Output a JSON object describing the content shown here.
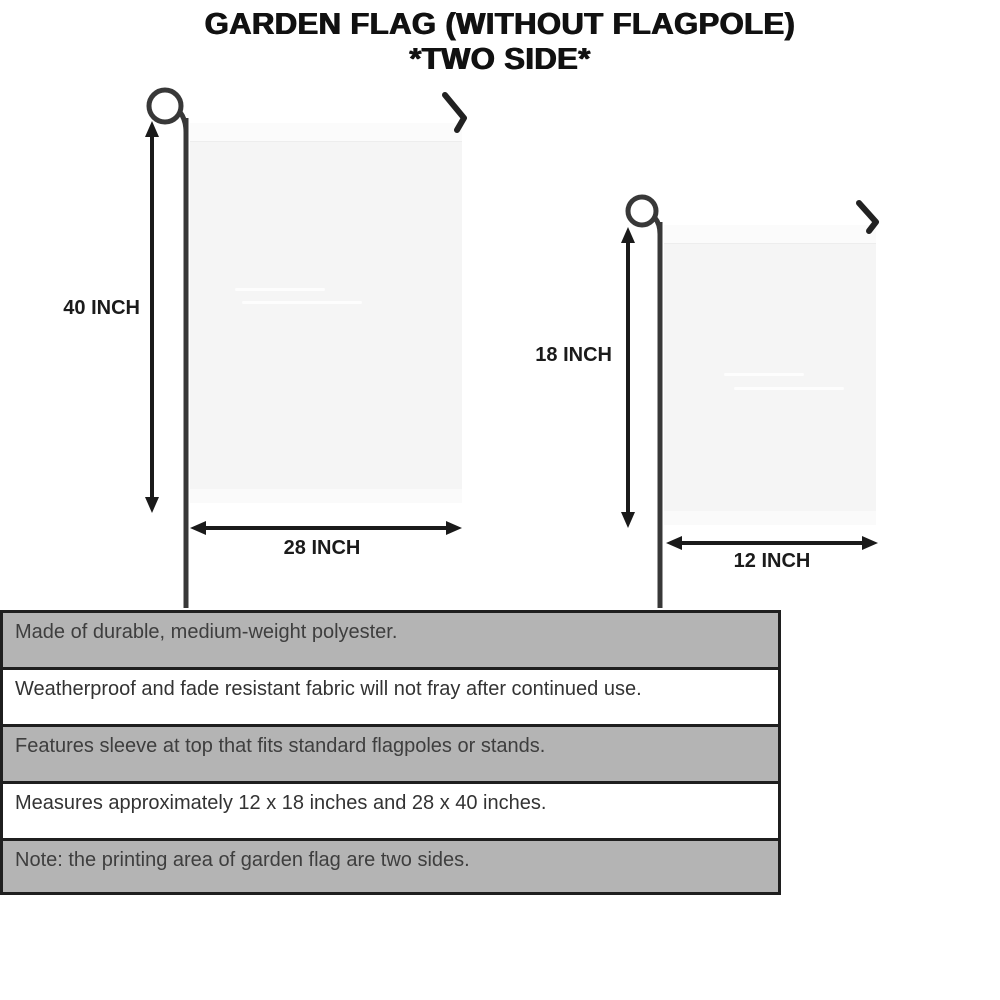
{
  "title": {
    "line1": "GARDEN FLAG (WITHOUT FLAGPOLE)",
    "line2": "*TWO SIDE*"
  },
  "diagram": {
    "large_flag": {
      "height_label": "40 INCH",
      "width_label": "28 INCH"
    },
    "small_flag": {
      "height_label": "18 INCH",
      "width_label": "12 INCH"
    }
  },
  "features": {
    "rows": [
      {
        "text": "Made of durable, medium-weight polyester.",
        "shaded": true
      },
      {
        "text": "Weatherproof and fade resistant fabric will not fray after continued use.",
        "shaded": false
      },
      {
        "text": "Features sleeve at top that fits standard flagpoles or stands.",
        "shaded": true
      },
      {
        "text": "Measures approximately 12 x 18 inches and 28 x 40 inches.",
        "shaded": false
      },
      {
        "text": "Note: the printing area of garden flag are two sides.",
        "shaded": true
      }
    ]
  },
  "colors": {
    "row_shaded_bg": "#b4b4b4",
    "row_plain_bg": "#ffffff",
    "flag_fill": "#f5f5f5",
    "line_color": "#1a1a1a",
    "pole_color": "#383838",
    "text_dark": "#3e3e3e",
    "title_color": "#111111"
  }
}
